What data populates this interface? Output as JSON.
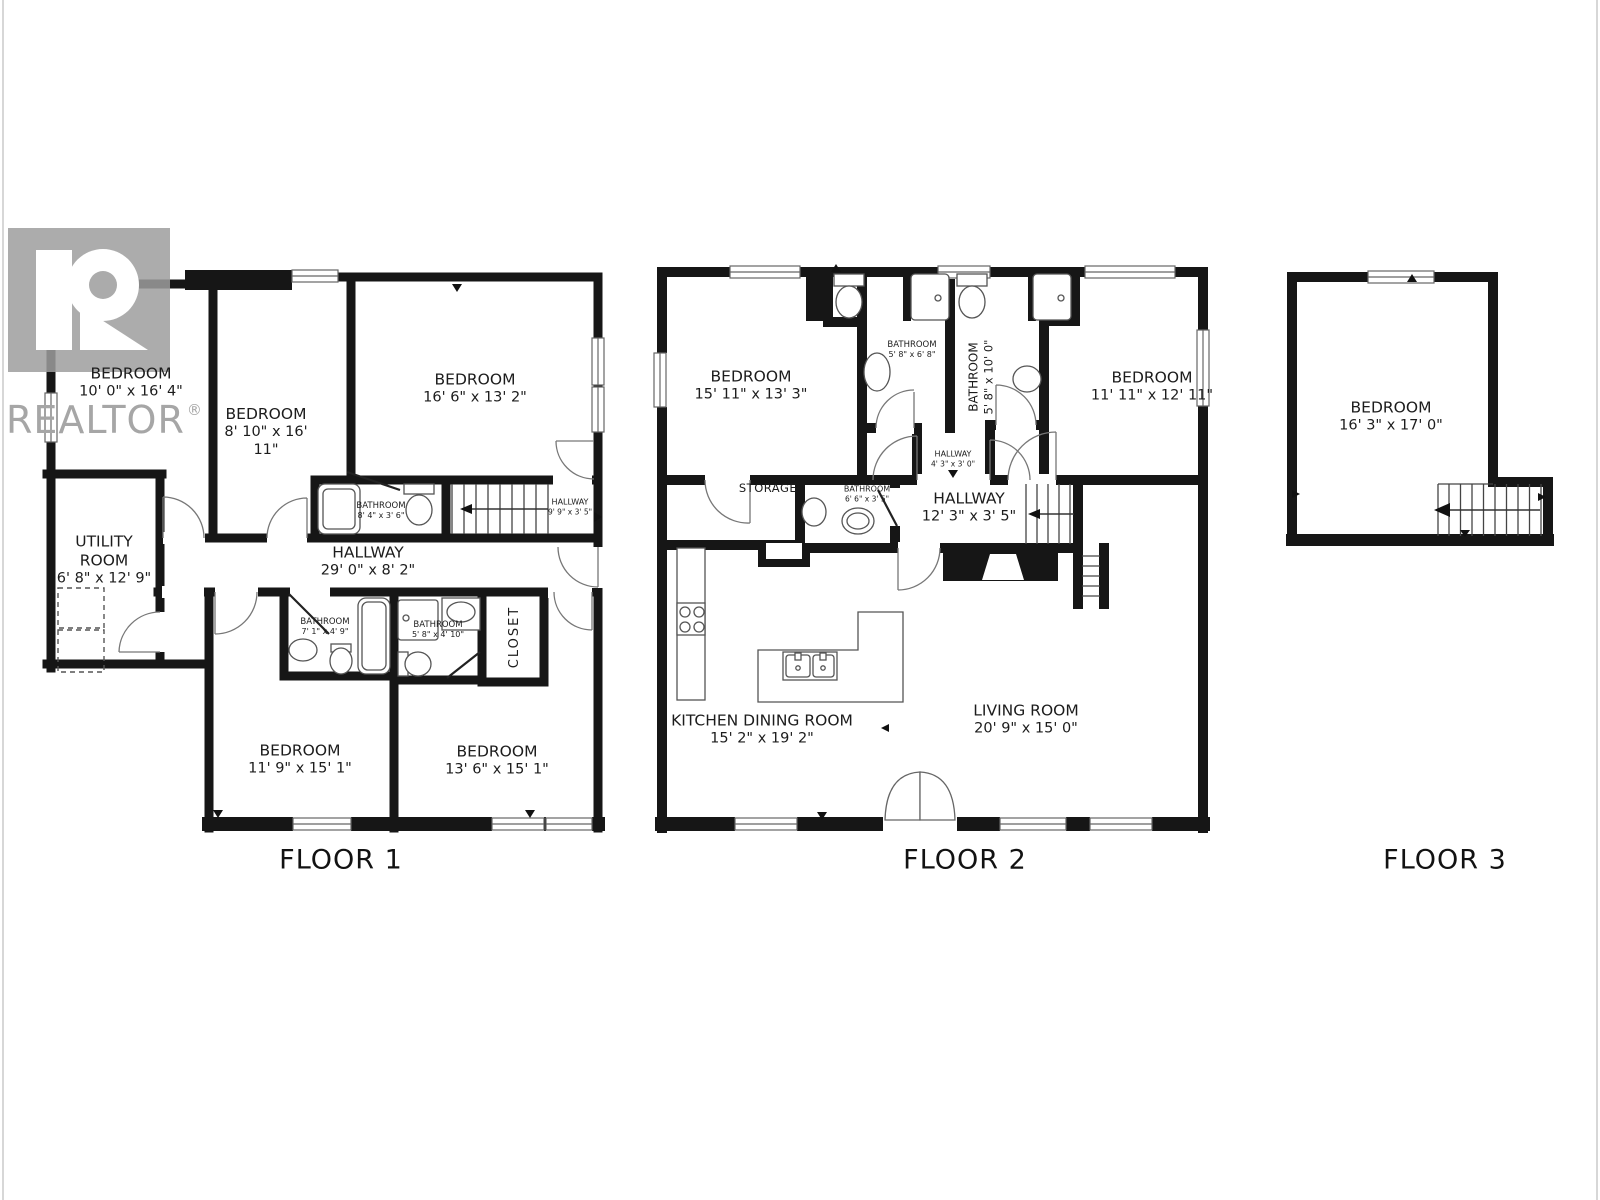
{
  "watermark": {
    "brand": "REALTOR",
    "registered": "®"
  },
  "floors": [
    {
      "label": "FLOOR 1",
      "rooms": [
        {
          "name": "BEDROOM",
          "dims": "10' 0\" x 16' 4\""
        },
        {
          "name": "BEDROOM",
          "dims": "8' 10\" x 16' 11\""
        },
        {
          "name": "BEDROOM",
          "dims": "16' 6\" x 13' 2\""
        },
        {
          "name": "UTILITY ROOM",
          "dims": "6' 8\" x 12' 9\""
        },
        {
          "name": "HALLWAY",
          "dims": "29' 0\" x 8' 2\""
        },
        {
          "name": "BATHROOM",
          "dims": "8' 4\" x 3' 6\""
        },
        {
          "name": "HALLWAY",
          "dims": "9' 9\" x 3' 5\""
        },
        {
          "name": "BATHROOM",
          "dims": "7' 1\" x 4' 9\""
        },
        {
          "name": "BATHROOM",
          "dims": "5' 8\" x 4' 10\""
        },
        {
          "name": "CLOSET",
          "dims": ""
        },
        {
          "name": "BEDROOM",
          "dims": "11' 9\" x 15' 1\""
        },
        {
          "name": "BEDROOM",
          "dims": "13' 6\" x 15' 1\""
        }
      ]
    },
    {
      "label": "FLOOR 2",
      "rooms": [
        {
          "name": "BEDROOM",
          "dims": "15' 11\" x 13' 3\""
        },
        {
          "name": "BATHROOM",
          "dims": "5' 8\" x 6' 8\""
        },
        {
          "name": "BATHROOM",
          "dims": "5' 8\" x 10' 0\""
        },
        {
          "name": "BEDROOM",
          "dims": "11' 11\" x 12' 11\""
        },
        {
          "name": "HALLWAY",
          "dims": "4' 3\" x 3' 0\""
        },
        {
          "name": "STORAGE",
          "dims": ""
        },
        {
          "name": "BATHROOM",
          "dims": "6' 6\" x 3' 5\""
        },
        {
          "name": "HALLWAY",
          "dims": "12' 3\" x 3' 5\""
        },
        {
          "name": "KITCHEN DINING ROOM",
          "dims": "15' 2\" x 19' 2\""
        },
        {
          "name": "LIVING ROOM",
          "dims": "20' 9\" x 15' 0\""
        }
      ]
    },
    {
      "label": "FLOOR 3",
      "rooms": [
        {
          "name": "BEDROOM",
          "dims": "16' 3\" x 17' 0\""
        }
      ]
    }
  ]
}
